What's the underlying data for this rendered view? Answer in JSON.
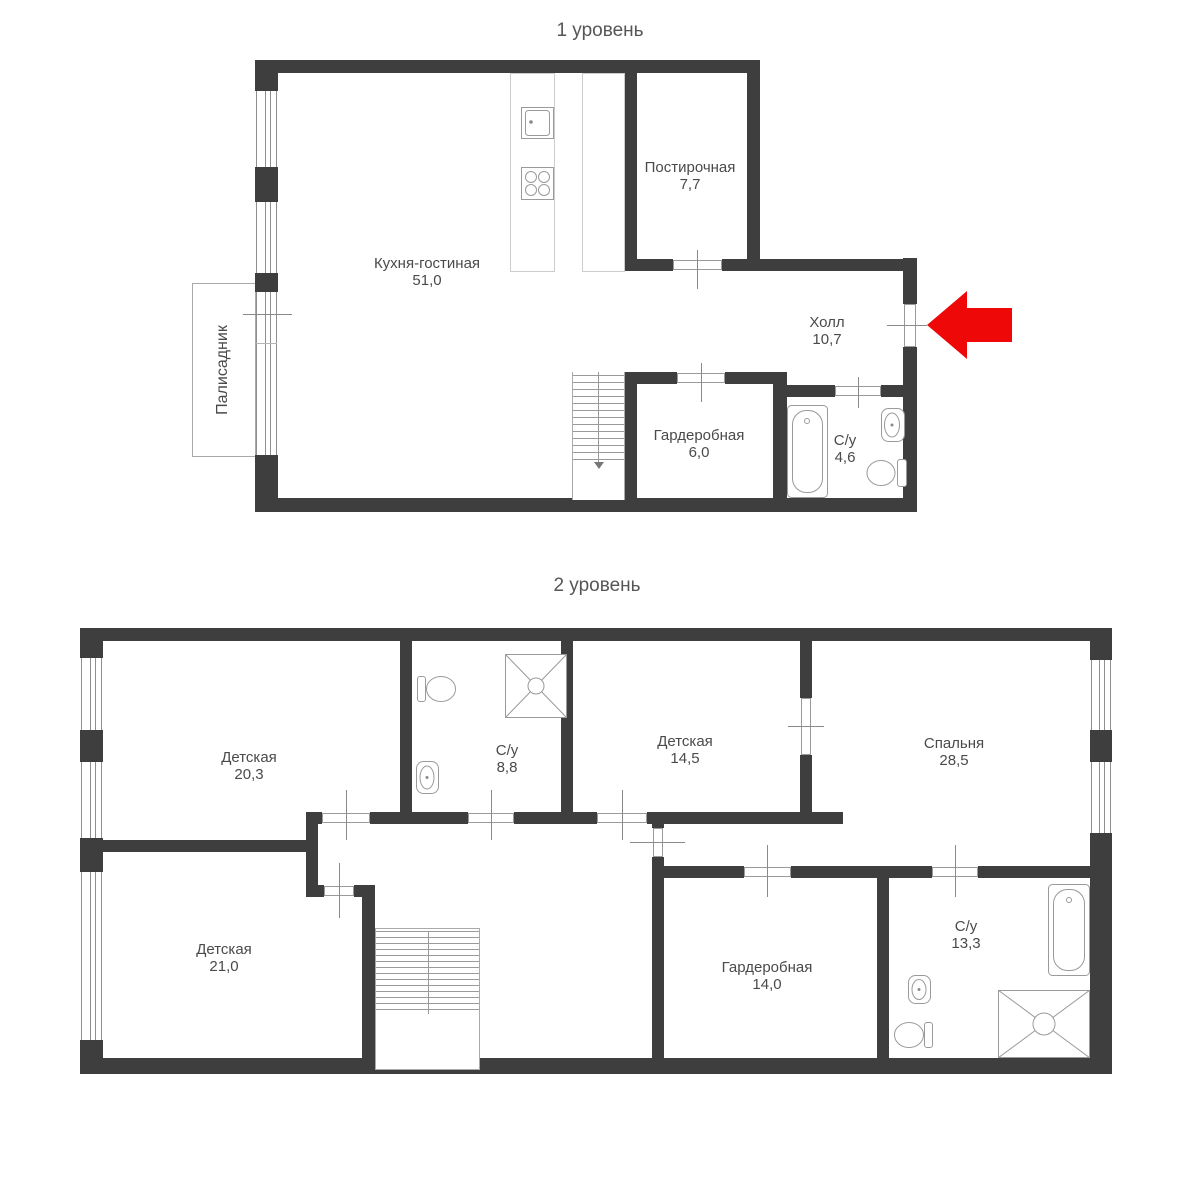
{
  "levels": [
    {
      "title": "1 уровень",
      "rooms": [
        {
          "name": "Кухня-гостиная",
          "area": "51,0"
        },
        {
          "name": "Постирочная",
          "area": "7,7"
        },
        {
          "name": "Холл",
          "area": "10,7"
        },
        {
          "name": "Гардеробная",
          "area": "6,0"
        },
        {
          "name": "С/у",
          "area": "4,6"
        }
      ],
      "outdoor_label": "Палисадник"
    },
    {
      "title": "2 уровень",
      "rooms": [
        {
          "name": "Детская",
          "area": "20,3"
        },
        {
          "name": "С/у",
          "area": "8,8"
        },
        {
          "name": "Детская",
          "area": "14,5"
        },
        {
          "name": "Спальня",
          "area": "28,5"
        },
        {
          "name": "Детская",
          "area": "21,0"
        },
        {
          "name": "Гардеробная",
          "area": "14,0"
        },
        {
          "name": "С/у",
          "area": "13,3"
        }
      ]
    }
  ],
  "annotations": {
    "entrance_arrow_color": "#ee0808"
  },
  "colors": {
    "wall": "#3e3e3e",
    "line": "#9a9a9a",
    "text": "#4a4a4a",
    "title": "#565656"
  }
}
